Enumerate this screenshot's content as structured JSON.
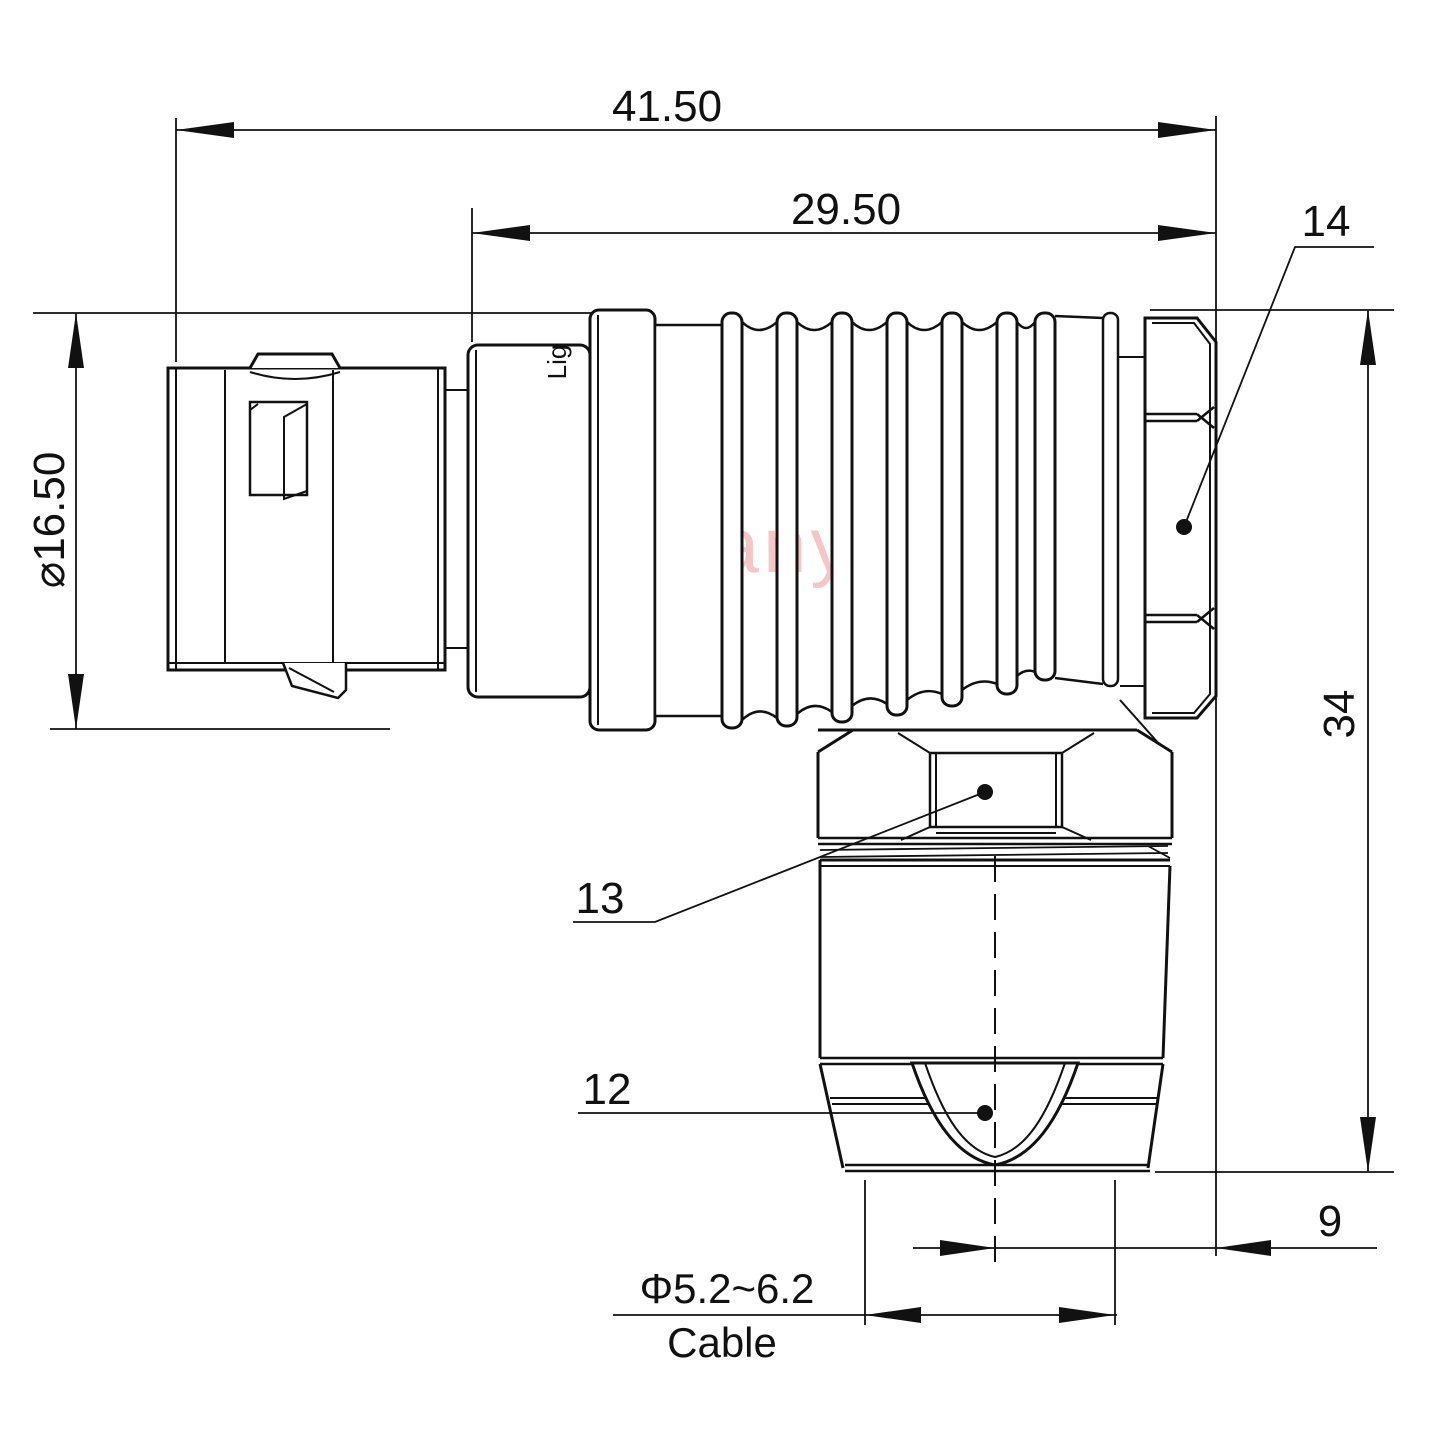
{
  "watermark": "Lightany",
  "stamp": "Lig",
  "colors": {
    "line": "#111111",
    "watermark": "#f2b4b4",
    "background": "#ffffff"
  },
  "dimensions": {
    "overall_length": "41.50",
    "rear_section_length": "29.50",
    "shell_diameter": "⌀16.50",
    "overall_height": "34",
    "cable_axis_offset": "9",
    "cable_diameter_range": "Φ5.2~6.2",
    "cable_caption": "Cable"
  },
  "part_labels": {
    "coupling_nut": "14",
    "spanner_flat": "13",
    "cable_grommet": "12"
  }
}
